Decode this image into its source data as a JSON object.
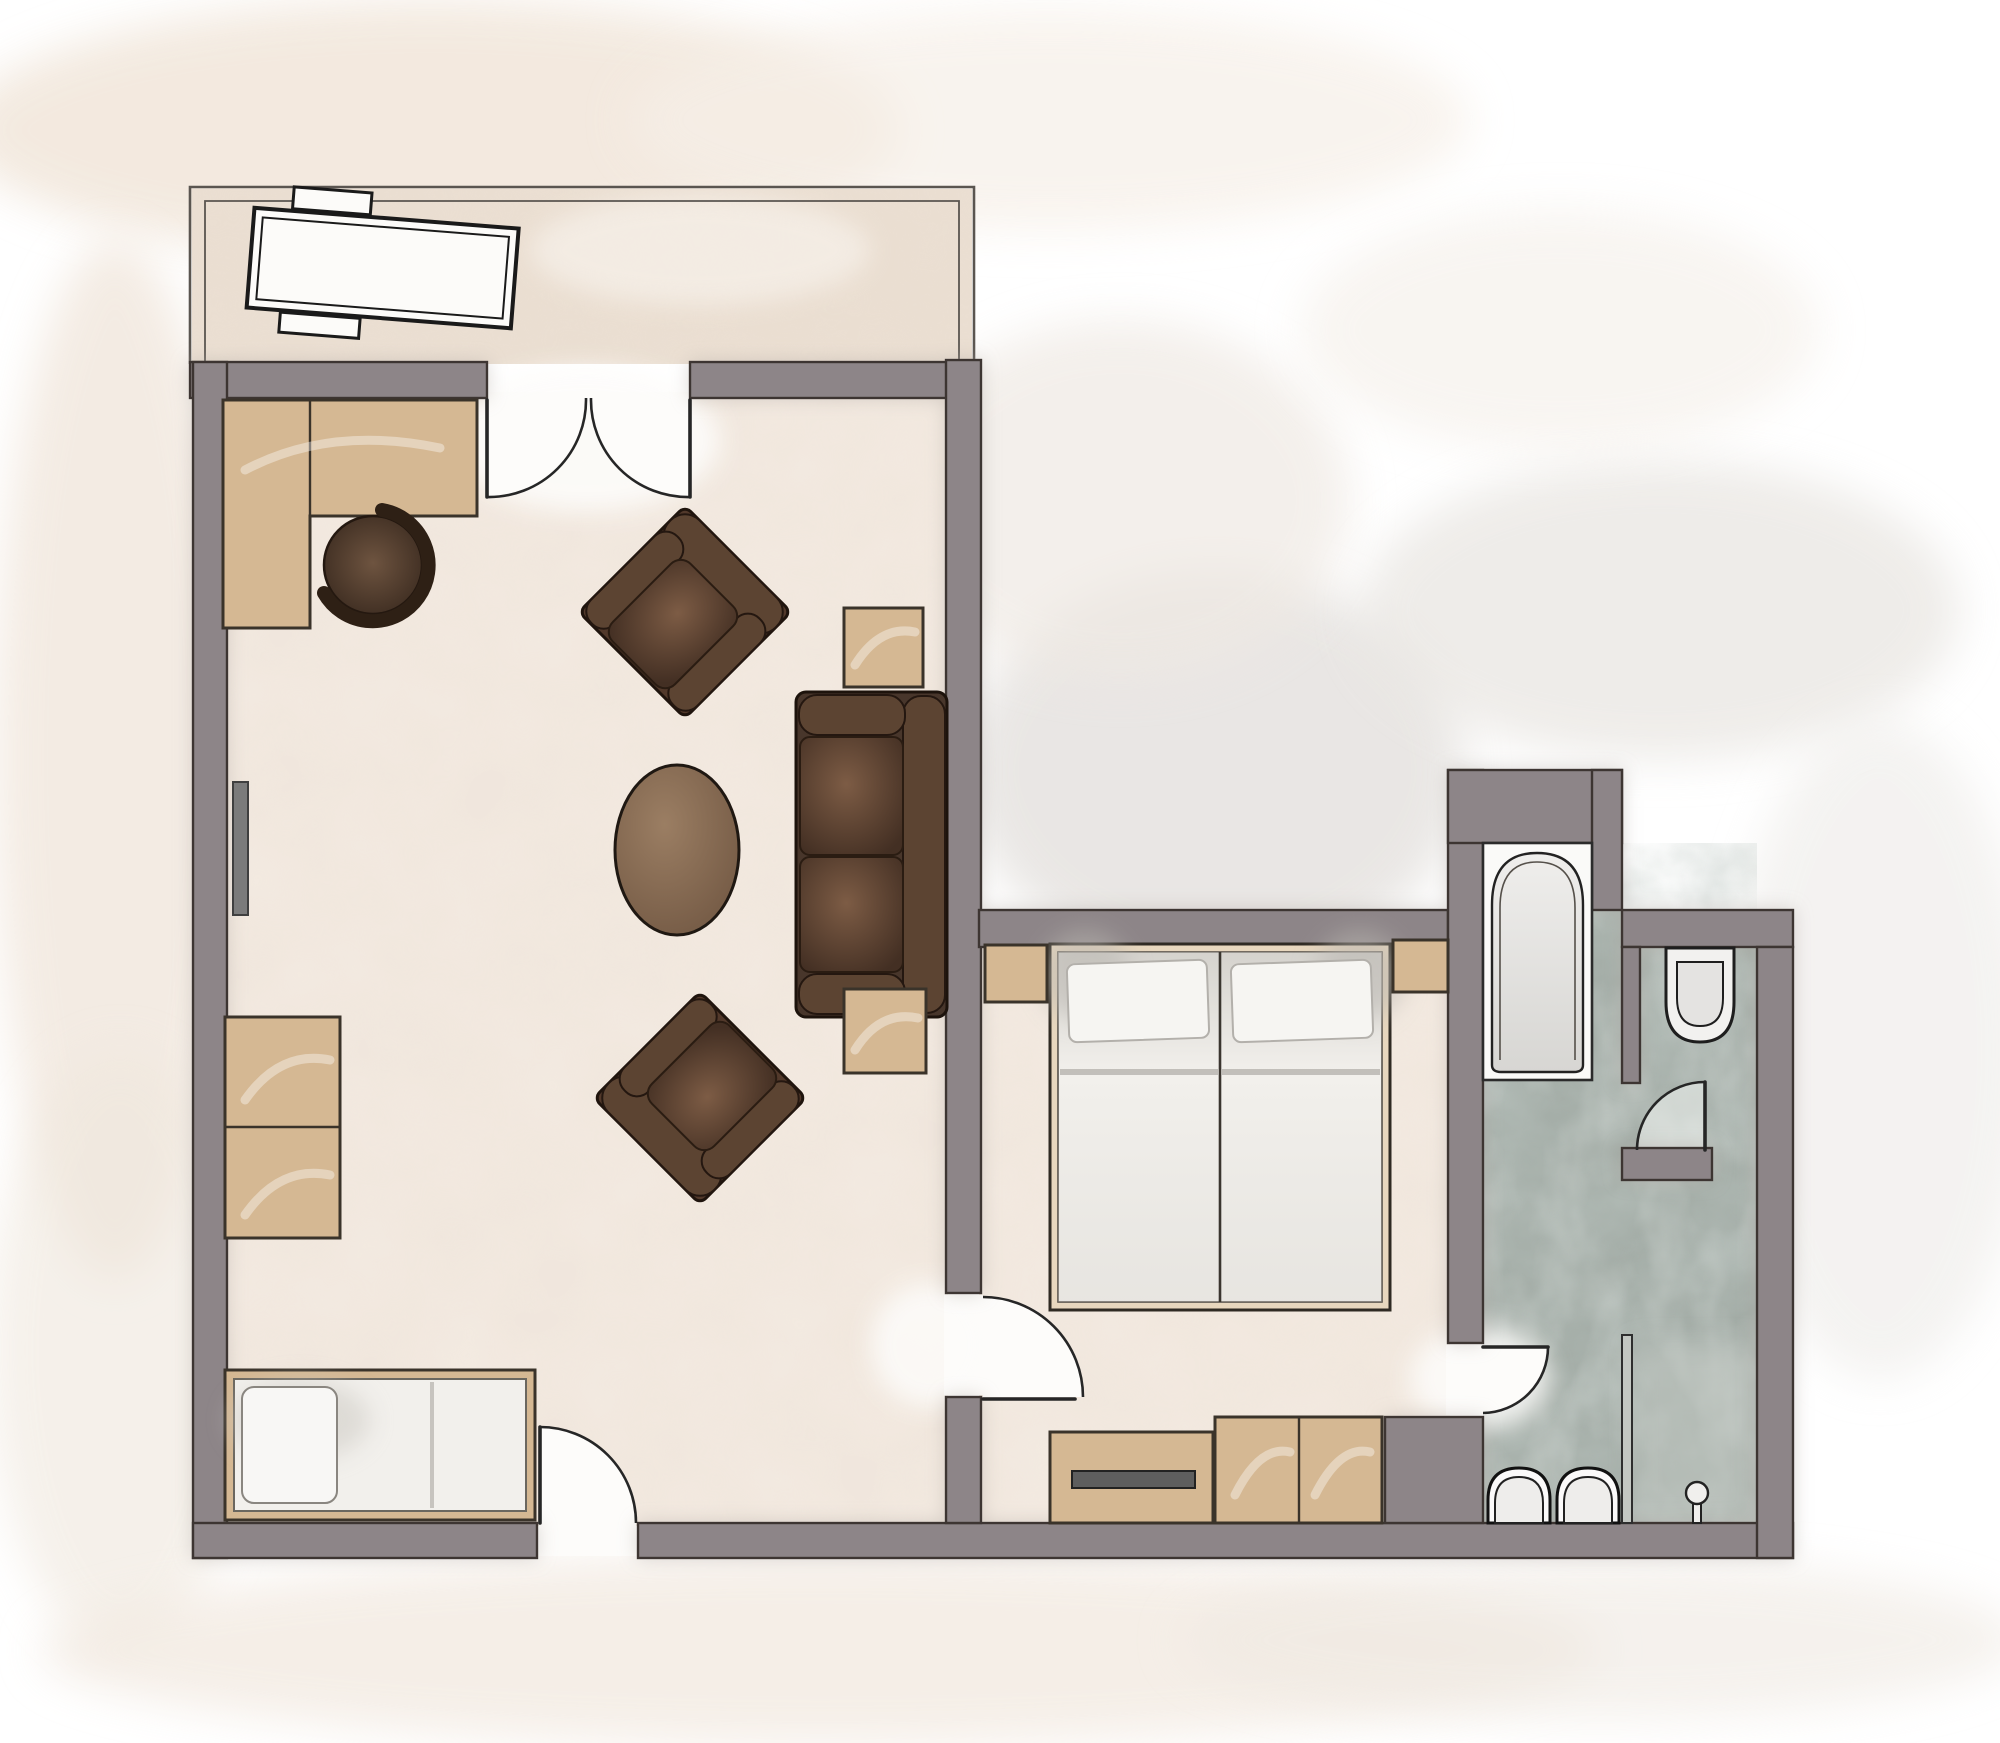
{
  "document": {
    "kind": "architectural floor plan",
    "rendering_style": "hand-rendered watercolor plan, top view",
    "visible_text": ""
  },
  "colors": {
    "page": "#ffffff",
    "wall": "#8d8588",
    "wall_line": "#3c3631",
    "floor": "#f3eae1",
    "floor_balcony": "#ebdfd2",
    "bath_floor": "#a3aca6",
    "bath_floor_light": "#c2c8c2",
    "wood": "#d5b893",
    "wood_line": "#3a332a",
    "sofa_dark": "#48362b",
    "sofa_line": "#1d130c",
    "roll": "#5c4432",
    "table_brown": "#8a6e57",
    "white_furniture": "#f2f0ec",
    "tv": "#5e5e5e",
    "radiator": "#7b7b7b",
    "glass": "#c3c7c2",
    "line": "#262626"
  },
  "rooms": [
    {
      "id": "balcony",
      "name": "balcony",
      "furniture": [
        "sun-lounger",
        "lounger-side-table",
        "lounger-foot-stool"
      ]
    },
    {
      "id": "living-room",
      "name": "living room",
      "furniture": [
        "corner-desk",
        "desk-chair",
        "radiator",
        "storage-cabinet",
        "daybed",
        "armchair-upper",
        "armchair-lower",
        "oval-coffee-table",
        "sofa",
        "side-table-upper",
        "side-table-lower"
      ]
    },
    {
      "id": "bedroom",
      "name": "bedroom",
      "furniture": [
        "double-bed",
        "nightstand-left",
        "nightstand-right",
        "tv-sideboard",
        "tv",
        "wardrobe"
      ]
    },
    {
      "id": "bathroom",
      "name": "bathroom",
      "furniture": [
        "bathtub",
        "toilet",
        "washbasin-left",
        "washbasin-right",
        "shower-fixture",
        "glass-partition"
      ]
    }
  ],
  "doors": [
    {
      "id": "balcony-french-door",
      "type": "double french door",
      "between": "living room / balcony"
    },
    {
      "id": "entry-door",
      "type": "single swing",
      "between": "exterior / living room"
    },
    {
      "id": "bedroom-door",
      "type": "single swing",
      "between": "living room / bedroom"
    },
    {
      "id": "bathroom-door",
      "type": "single swing",
      "between": "bedroom / bathroom"
    },
    {
      "id": "wc-door",
      "type": "single swing",
      "between": "bathroom / wc niche"
    }
  ]
}
